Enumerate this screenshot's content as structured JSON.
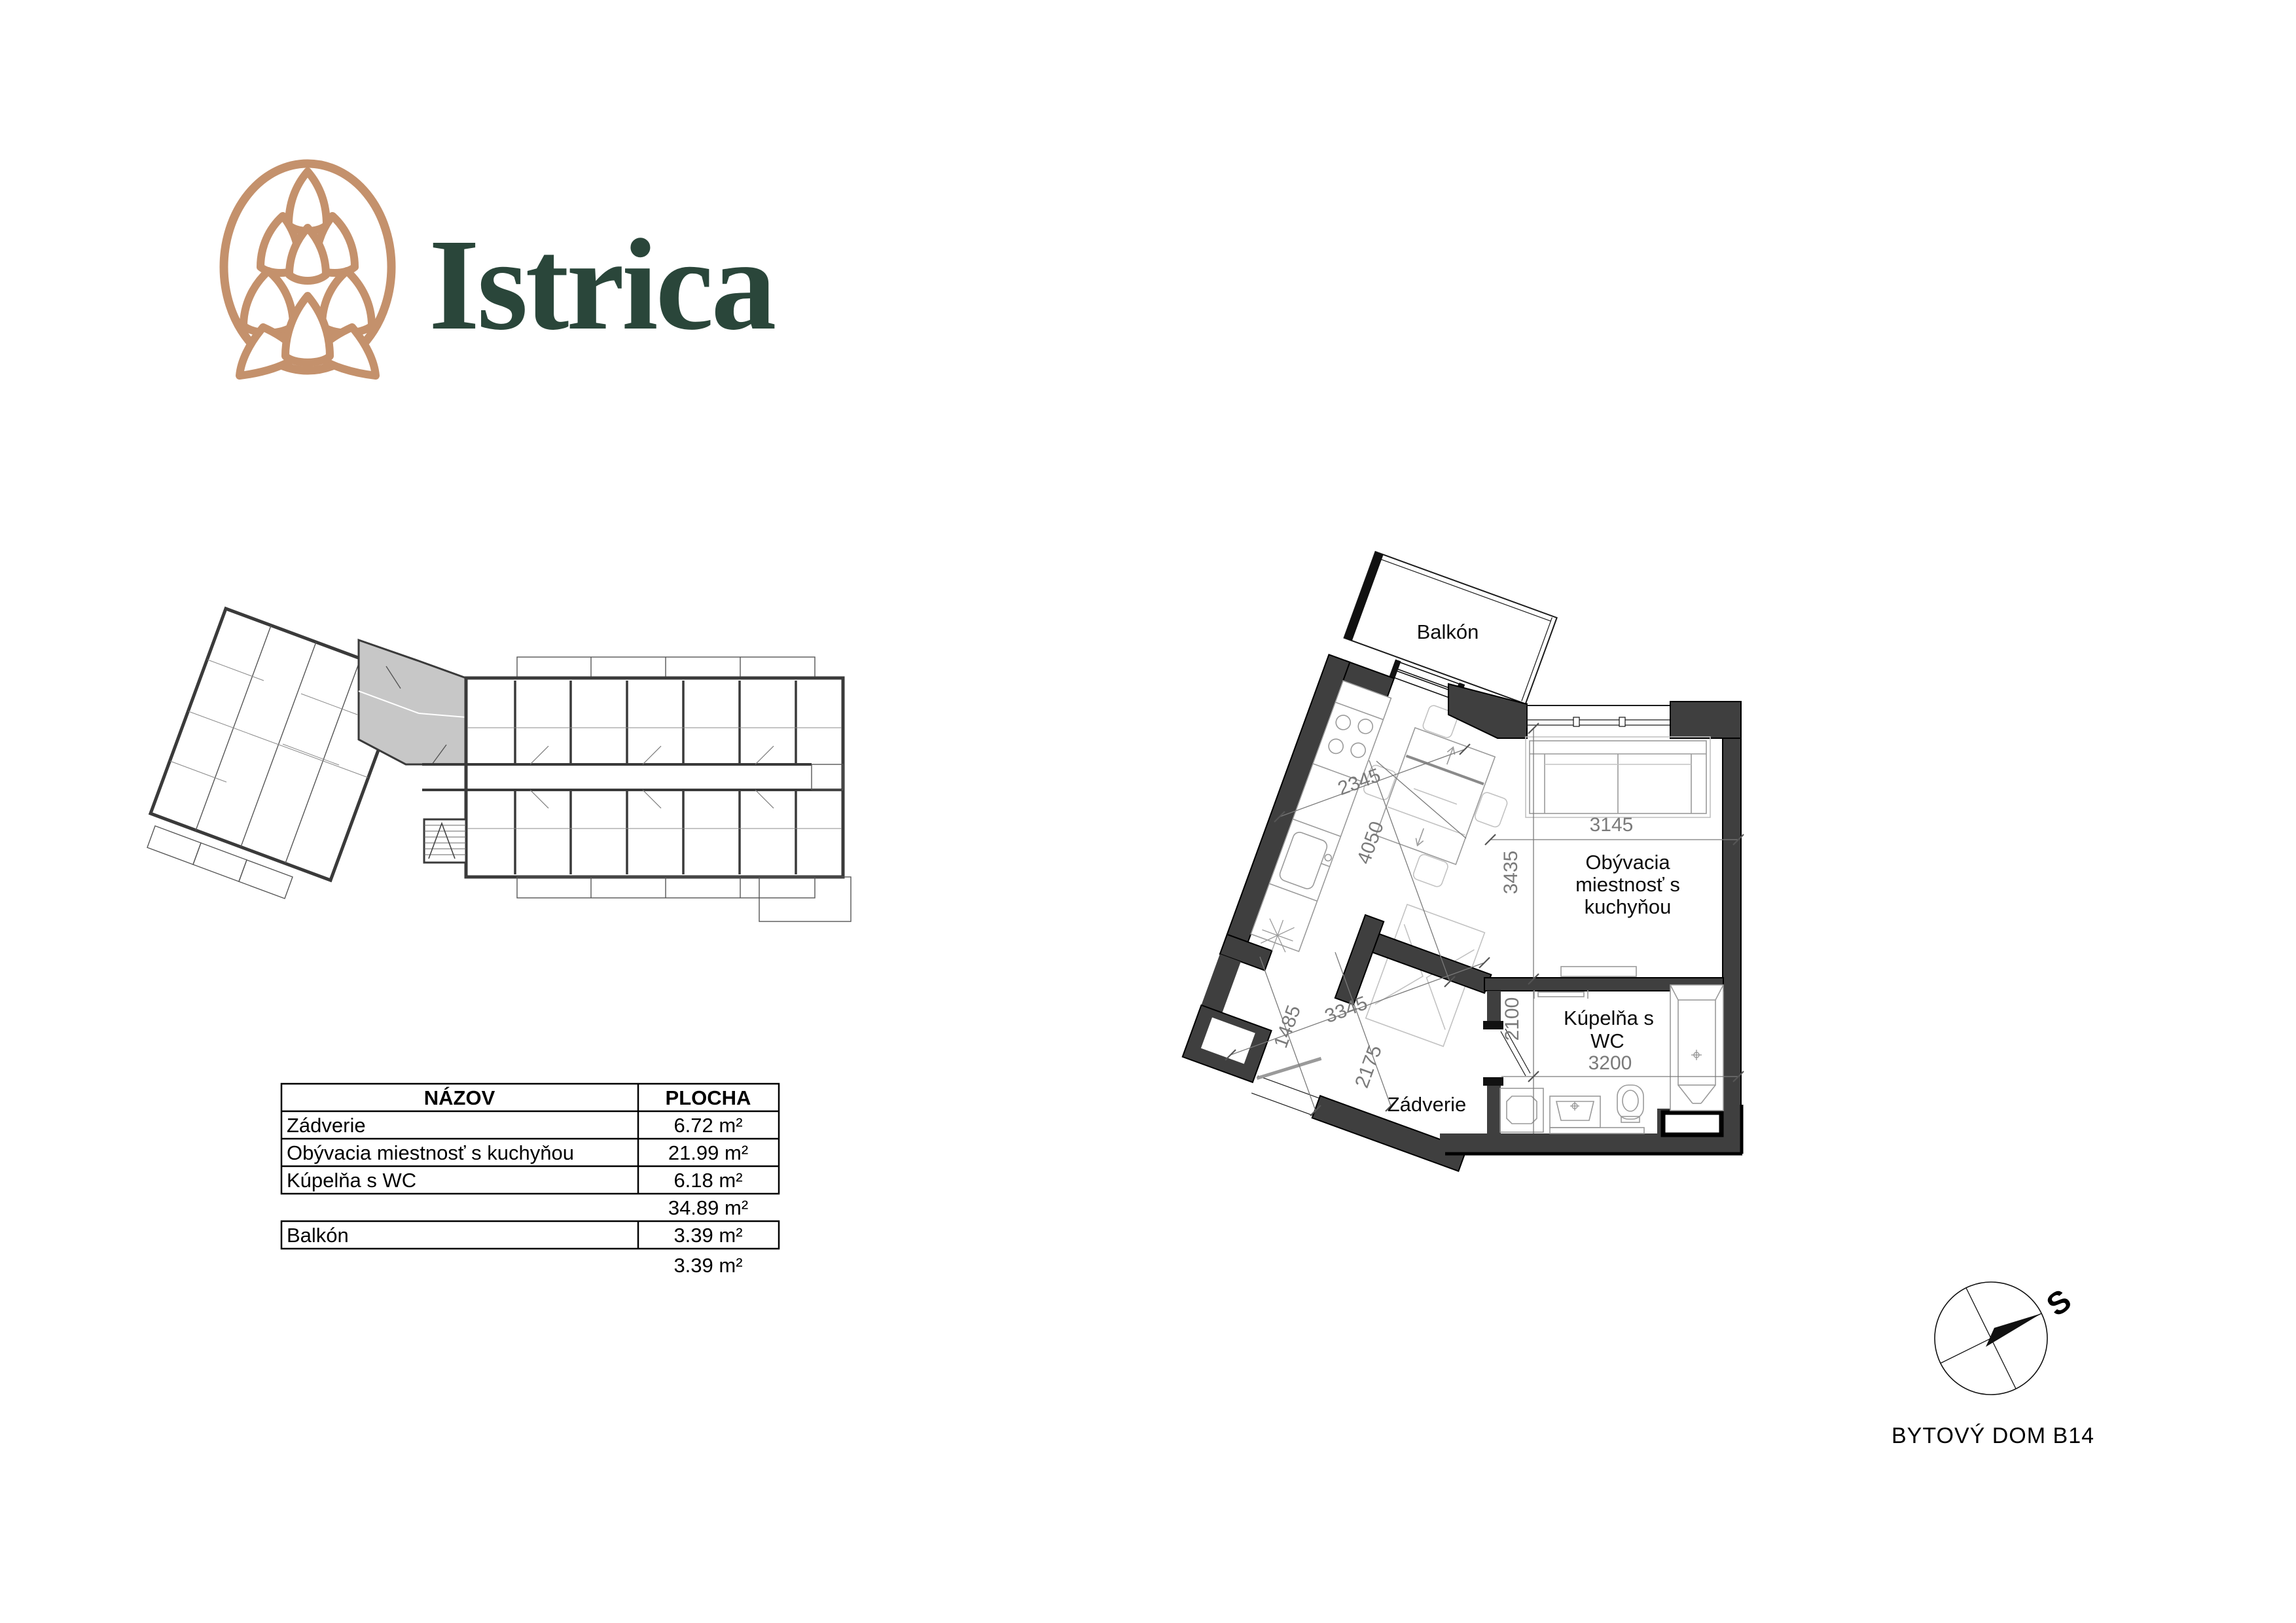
{
  "logo": {
    "brand": "Istrica"
  },
  "table": {
    "header": {
      "name": "NÁZOV",
      "area": "PLOCHA"
    },
    "rows": [
      {
        "name": "Zádverie",
        "area": "6.72 m²"
      },
      {
        "name": "Obývacia miestnosť s kuchyňou",
        "area": "21.99 m²"
      },
      {
        "name": "Kúpelňa s WC",
        "area": "6.18 m²"
      }
    ],
    "interior_total": "34.89 m²",
    "balcony_row": {
      "name": "Balkón",
      "area": "3.39 m²"
    },
    "balcony_total": "3.39 m²"
  },
  "floor_plan": {
    "rooms": {
      "balcony": "Balkón",
      "living_line1": "Obývacia",
      "living_line2": "miestnosť s",
      "living_line3": "kuchyňou",
      "bathroom_line1": "Kúpelňa s",
      "bathroom_line2": "WC",
      "hallway": "Zádverie"
    },
    "dimensions": {
      "kitchen_width": "2345",
      "kitchen_length": "4050",
      "living_width": "3145",
      "living_depth": "3435",
      "hall_width": "3345",
      "hall_depth": "1485",
      "hall_height": "2175",
      "bath_depth": "2100",
      "bath_width": "3200"
    }
  },
  "compass": {
    "north": "S"
  },
  "footer": {
    "title": "BYTOVÝ DOM B14"
  }
}
